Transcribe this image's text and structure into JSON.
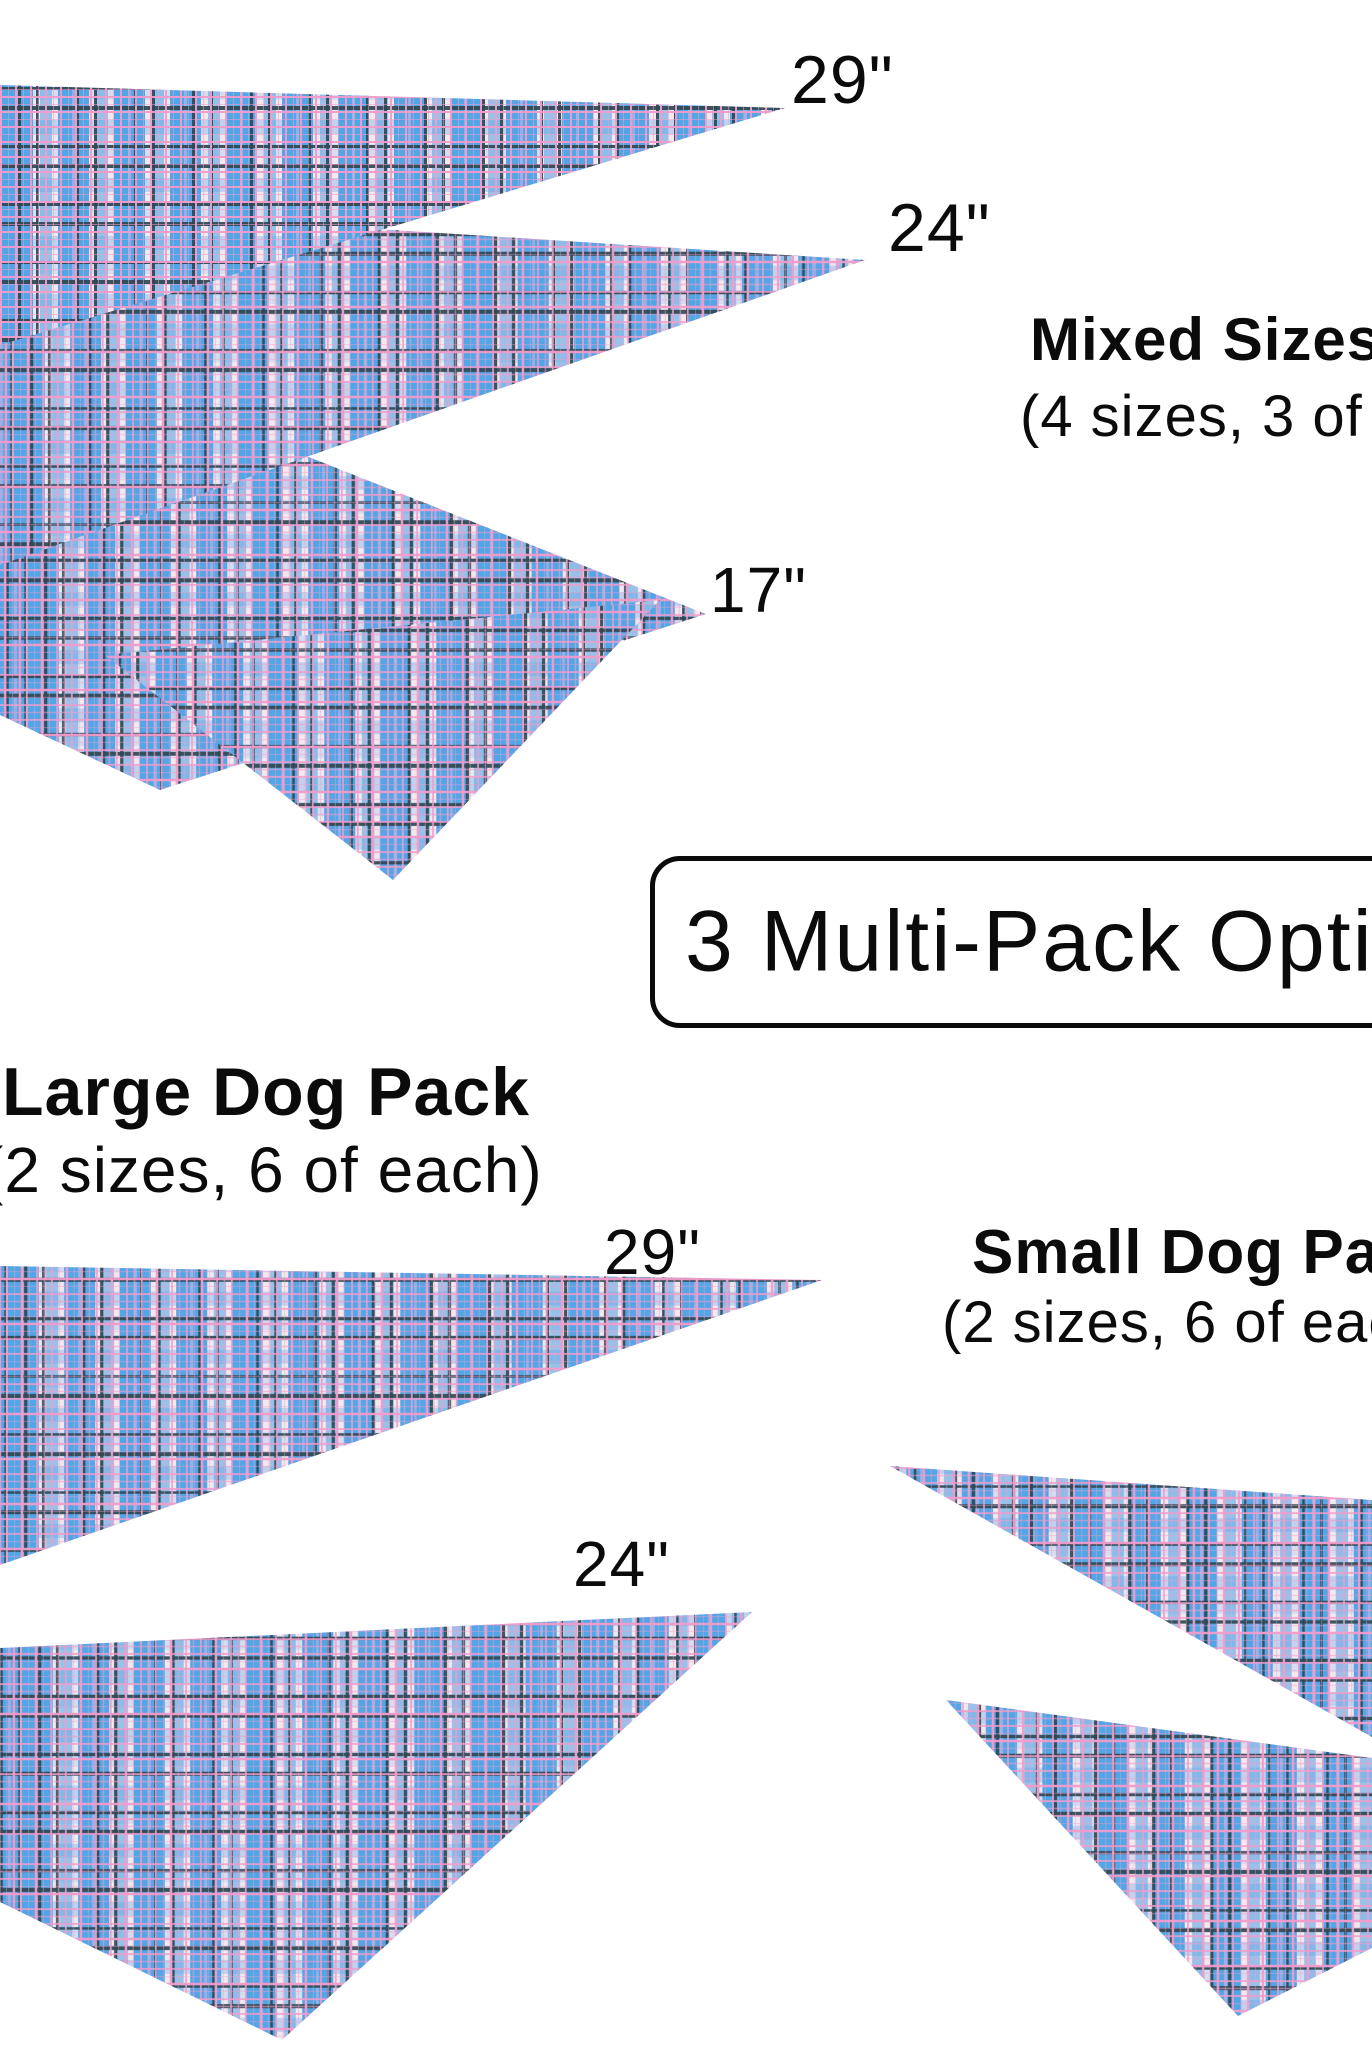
{
  "image": {
    "type": "dog-bandana-multipack-product-graphic",
    "background": "#ffffff"
  },
  "banner": {
    "text": "3 Multi-Pack Options"
  },
  "mixed_pack": {
    "title": "Mixed Sizes",
    "subtitle": "(4 sizes, 3 of each)",
    "size_labels": [
      "29\"",
      "24\"",
      "17\""
    ]
  },
  "large_pack": {
    "title": "Large Dog Pack",
    "subtitle": "(2 sizes, 6 of each)",
    "size_labels": [
      "29\"",
      "24\""
    ]
  },
  "small_pack": {
    "title": "Small Dog Pack",
    "subtitle": "(2 sizes, 6 of each)"
  },
  "colors": {
    "text": "#0b0b0b",
    "plaid_base": "#f2e9ef",
    "plaid_blue": "#4aa3e6",
    "plaid_pink": "#f19ccb",
    "plaid_dark": "#2d4852",
    "box_border": "#0b0b0b"
  }
}
